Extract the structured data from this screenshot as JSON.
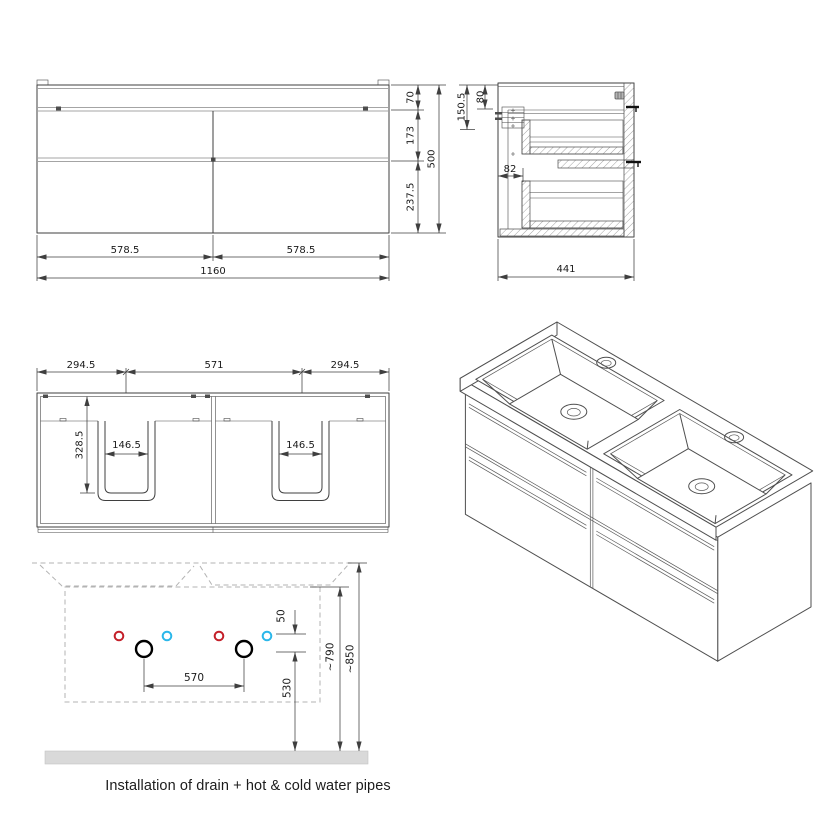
{
  "front_view": {
    "width_left": "578.5",
    "width_right": "578.5",
    "width_total": "1160",
    "height_top": "70",
    "height_upper_drawer": "173",
    "height_lower_drawer": "237.5",
    "height_total": "500"
  },
  "side_view": {
    "hanger_height": "150.5",
    "hanger_inset": "80",
    "back_offset": "82",
    "depth_total": "441"
  },
  "top_view": {
    "offset_left": "294.5",
    "basin_spacing": "571",
    "offset_right": "294.5",
    "cutout_depth": "328.5",
    "cutout_width_left": "146.5",
    "cutout_width_right": "146.5"
  },
  "installation_view": {
    "pipe_offset": "50",
    "drain_spacing": "570",
    "drain_height": "530",
    "cabinet_height": "~790",
    "basin_height": "~850",
    "caption": "Installation of drain + hot & cold water pipes"
  },
  "colors": {
    "hot_water": "#c4202a",
    "cold_water": "#2bb7ea",
    "drain": "#000000",
    "floor": "#d9d9d9"
  }
}
